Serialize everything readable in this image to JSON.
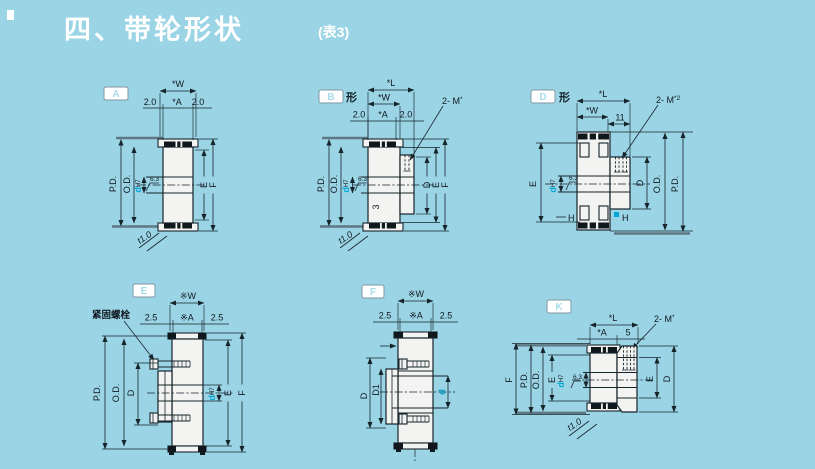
{
  "page": {
    "title": "四、带轮形状",
    "table_ref": "(表3)"
  },
  "colors": {
    "background": "#9bd4e4",
    "line": "#16242c",
    "body_fill": "#f3f3f1",
    "accent_cyan": "#00a9d6",
    "title_text": "#ffffff"
  },
  "diagrams": {
    "a": {
      "tag": "A",
      "dim_w": "*W",
      "edge_left": "2.0",
      "dim_a": "*A",
      "edge_right": "2.0",
      "pd": "P.D.",
      "od": "O.D.",
      "bore": "d",
      "bore_fit": "H7",
      "finish": "6.3",
      "dim_e": "E",
      "dim_f": "F",
      "flange_t": "t1.0"
    },
    "b": {
      "tag": "B",
      "suffix": "形",
      "dim_l": "*L",
      "dim_w": "*W",
      "edge_left": "2.0",
      "dim_a": "*A",
      "edge_right": "2.0",
      "screws": "2- M",
      "screws_sup": "*",
      "pd": "P.D.",
      "od": "O.D.",
      "bore": "d",
      "bore_fit": "H7",
      "finish": "6.3",
      "web_mark": "3",
      "dim_d": "D",
      "dim_e": "E",
      "dim_f": "F",
      "flange_t": "t1.0"
    },
    "d": {
      "tag": "D",
      "suffix": "形",
      "dim_l": "*L",
      "dim_w": "*W",
      "hub_len": "11",
      "screws": "2- M",
      "screws_sup": "*2",
      "dim_e": "E",
      "bore": "d",
      "bore_fit": "H7",
      "finish": "6.3",
      "dim_d": "D",
      "od": "O.D.",
      "pd": "P.D.",
      "section_left": "H",
      "section_right": "H"
    },
    "e": {
      "tag": "E",
      "bolt_label": "紧固螺栓",
      "dim_w": "※W",
      "edge_left": "2.5",
      "dim_a": "※A",
      "edge_right": "2.5",
      "pd": "P.D.",
      "od": "O.D.",
      "dim_d": "D",
      "bore": "d",
      "bore_fit": "H7",
      "dim_e": "E",
      "dim_f": "F"
    },
    "f": {
      "tag": "F",
      "dim_w": "※W",
      "edge_left": "2.5",
      "dim_a": "※A",
      "edge_right": "2.5",
      "dim_d": "D",
      "dim_d1": "D1",
      "bore": "d"
    },
    "k": {
      "tag": "K",
      "dim_l": "*L",
      "dim_a": "*A",
      "hub_len": "5",
      "screws": "2- M",
      "screws_sup": "*",
      "dim_f": "F",
      "pd": "P.D.",
      "od": "O.D.",
      "dim_e_left": "E",
      "bore": "d",
      "bore_fit": "H7",
      "finish": "6.3",
      "dim_e_right": "E",
      "dim_d": "D",
      "flange_t": "t1.0"
    }
  }
}
